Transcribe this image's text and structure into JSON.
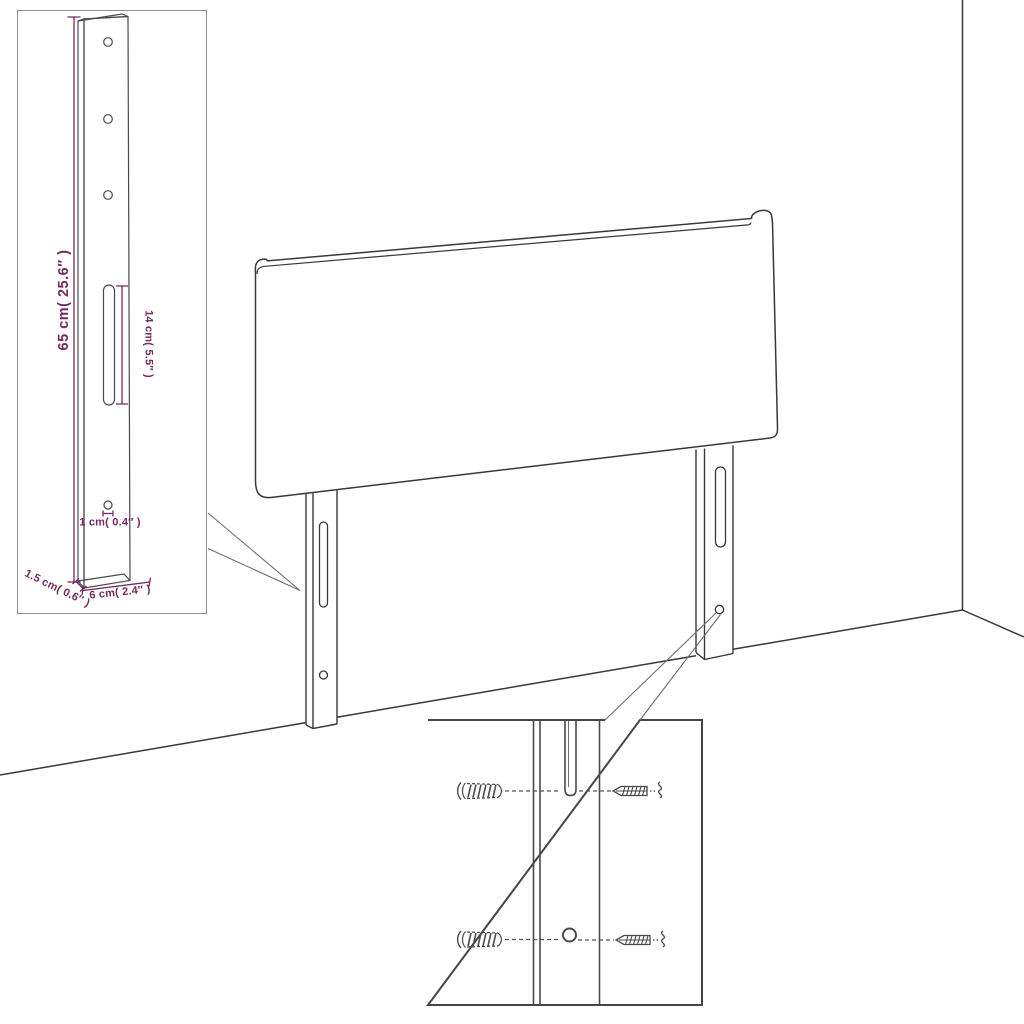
{
  "diagram_type": "headboard-assembly-dimension-diagram",
  "colors": {
    "background": "#ffffff",
    "line": "#383838",
    "inset_border_light": "#8f8f8f",
    "inset_border_dark": "#454545",
    "callout_line": "#6f6f6f",
    "dimension": "#752960"
  },
  "dimensions": {
    "leg_height": "65 cm( 25.6″ )",
    "slot_length": "14 cm( 5.5″ )",
    "hole_diameter": "1 cm( 0.4″ )",
    "leg_depth": "1.5 cm( 0.6″ )",
    "leg_width": "6 cm( 2.4″ )"
  }
}
